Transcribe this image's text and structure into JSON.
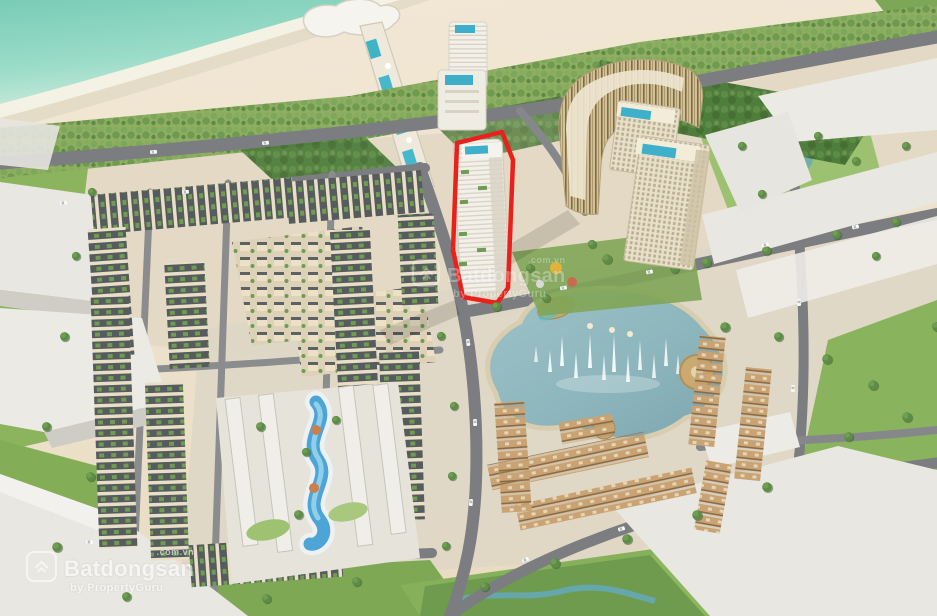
{
  "scene": {
    "description": "Aerial 3D architectural rendering of a beachfront resort and residential master plan; one high-rise tower is highlighted with a red outline",
    "width_px": 937,
    "height_px": 616
  },
  "watermarks": {
    "bottom_left": {
      "brand": "Batdongsan",
      "suffix": ".com.vn",
      "byline": "by PropertyGuru"
    },
    "center": {
      "brand": "Batdongsan",
      "suffix": ".com.vn",
      "byline": "by PropertyGuru"
    }
  },
  "highlight": {
    "name": "red-outlined high-rise tower",
    "outline_color": "#e8211d"
  },
  "palette": {
    "ocean": "#85d1bd",
    "foam": "#f4f2e8",
    "sand": "#ecdfc9",
    "palm_green": "#7da75a",
    "tree_green": "#53813f",
    "lawn_green": "#8cb45e",
    "road_gray": "#77797c",
    "building_white": "#efede6",
    "townhouse_cream": "#e7dcc0",
    "roof_dark": "#51565a",
    "villa_tan": "#c9a373",
    "tower_gold": "#d5c094",
    "lake_teal": "#8db6bd",
    "pool_blue": "#3fafc9"
  }
}
